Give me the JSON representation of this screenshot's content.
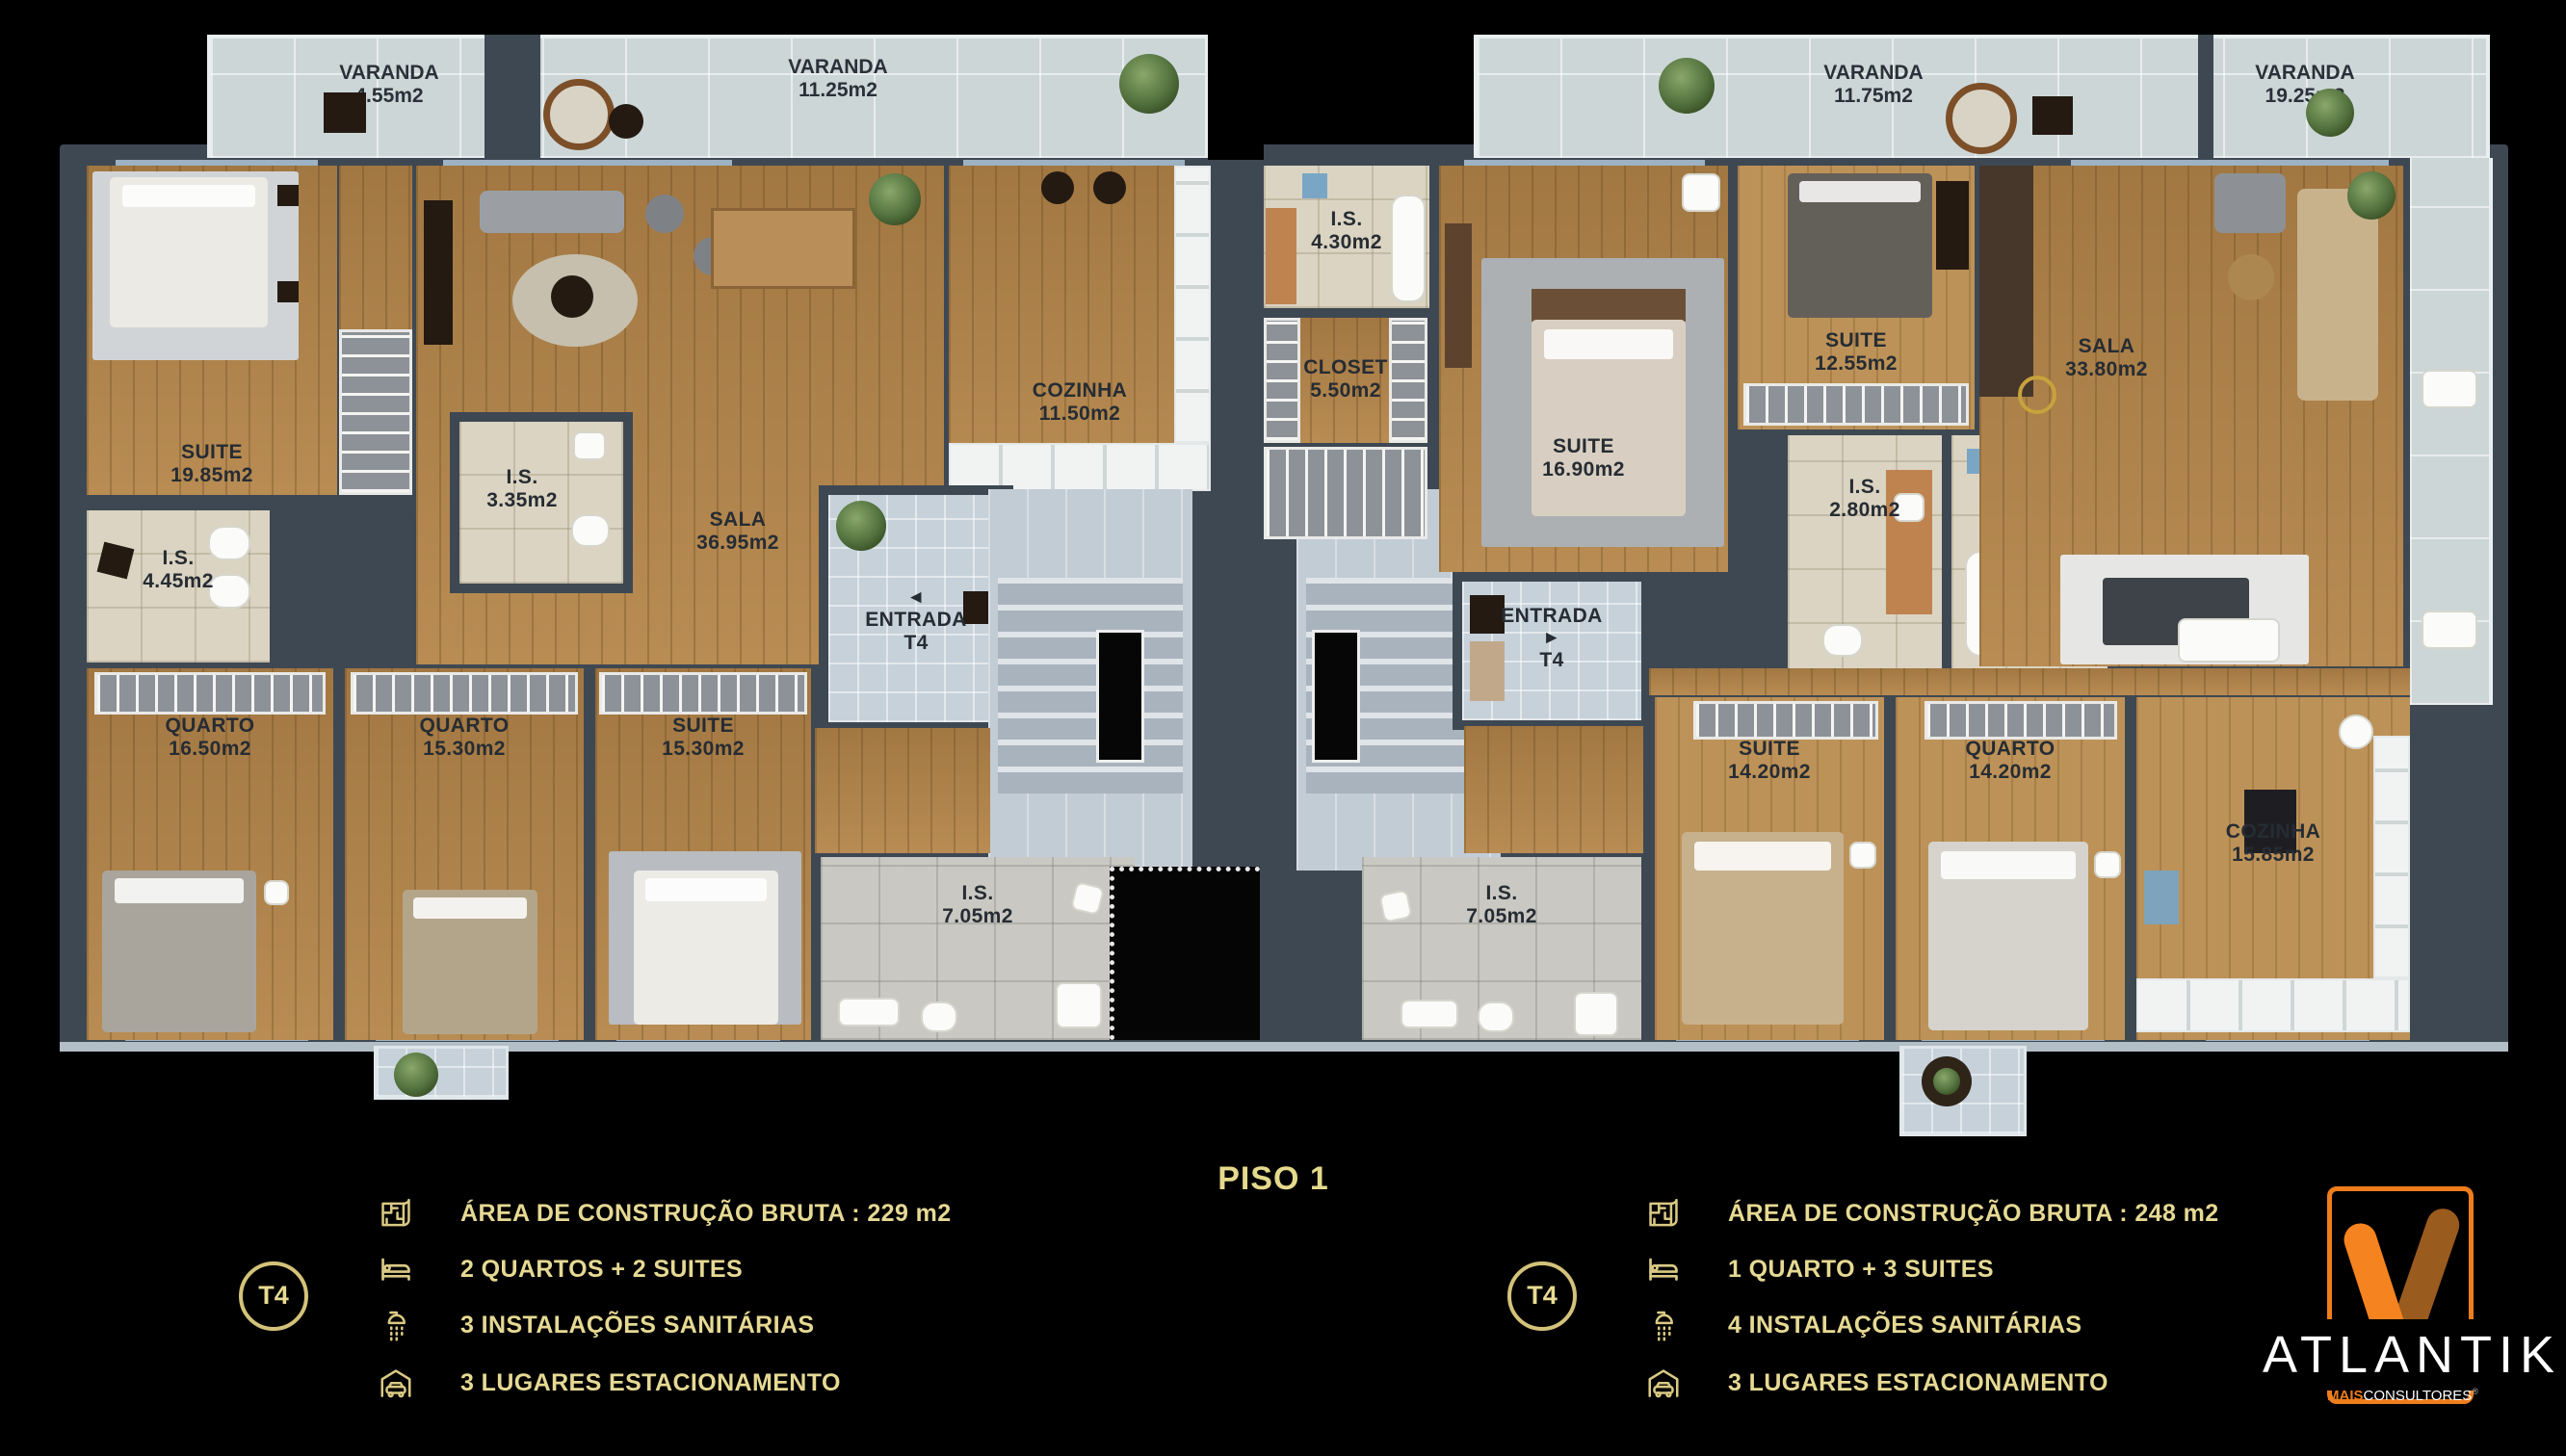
{
  "title": "PISO 1",
  "colors": {
    "accent_gold": "#e5d98c",
    "brand_orange": "#ee7d1c",
    "brand_brown": "#9a5b1e",
    "wall": "#3e4853",
    "wood_floor": "#b0834a"
  },
  "varandas": [
    {
      "name": "VARANDA",
      "area": "4.55m2"
    },
    {
      "name": "VARANDA",
      "area": "11.25m2"
    },
    {
      "name": "VARANDA",
      "area": "11.75m2"
    },
    {
      "name": "VARANDA",
      "area": "19.25m2"
    }
  ],
  "rooms": {
    "l_suite": {
      "name": "SUITE",
      "area": "19.85m2"
    },
    "l_is445": {
      "name": "I.S.",
      "area": "4.45m2"
    },
    "l_is335": {
      "name": "I.S.",
      "area": "3.35m2"
    },
    "l_sala": {
      "name": "SALA",
      "area": "36.95m2"
    },
    "l_cozinha": {
      "name": "COZINHA",
      "area": "11.50m2"
    },
    "l_entrada": {
      "name": "ENTRADA",
      "area": "T4",
      "arrow": "◄"
    },
    "l_quarto1": {
      "name": "QUARTO",
      "area": "16.50m2"
    },
    "l_quarto2": {
      "name": "QUARTO",
      "area": "15.30m2"
    },
    "l_suite2": {
      "name": "SUITE",
      "area": "15.30m2"
    },
    "l_is705": {
      "name": "I.S.",
      "area": "7.05m2"
    },
    "r_is430": {
      "name": "I.S.",
      "area": "4.30m2"
    },
    "r_closet": {
      "name": "CLOSET",
      "area": "5.50m2"
    },
    "r_suite1690": {
      "name": "SUITE",
      "area": "16.90m2"
    },
    "r_suite1255": {
      "name": "SUITE",
      "area": "12.55m2"
    },
    "r_is280": {
      "name": "I.S.",
      "area": "2.80m2"
    },
    "r_is305": {
      "name": "I.S.",
      "area": "3.05m2"
    },
    "r_sala": {
      "name": "SALA",
      "area": "33.80m2"
    },
    "r_entrada": {
      "name": "ENTRADA",
      "area": "T4",
      "arrow": "►"
    },
    "r_suite1420": {
      "name": "SUITE",
      "area": "14.20m2"
    },
    "r_quarto1420": {
      "name": "QUARTO",
      "area": "14.20m2"
    },
    "r_cozinha": {
      "name": "COZINHA",
      "area": "15.85m2"
    },
    "r_is705": {
      "name": "I.S.",
      "area": "7.05m2"
    }
  },
  "legend_left": {
    "badge": "T4",
    "rows": [
      {
        "icon": "floorplan-icon",
        "text": "ÁREA DE CONSTRUÇÃO BRUTA :  229 m2"
      },
      {
        "icon": "bed-icon",
        "text": "2 QUARTOS + 2 SUITES"
      },
      {
        "icon": "shower-icon",
        "text": "3 INSTALAÇÕES SANITÁRIAS"
      },
      {
        "icon": "garage-icon",
        "text": "3 LUGARES ESTACIONAMENTO"
      }
    ]
  },
  "legend_right": {
    "badge": "T4",
    "rows": [
      {
        "icon": "floorplan-icon",
        "text": "ÁREA DE CONSTRUÇÃO BRUTA :  248 m2"
      },
      {
        "icon": "bed-icon",
        "text": "1 QUARTO + 3 SUITES"
      },
      {
        "icon": "shower-icon",
        "text": "4 INSTALAÇÕES SANITÁRIAS"
      },
      {
        "icon": "garage-icon",
        "text": "3 LUGARES ESTACIONAMENTO"
      }
    ]
  },
  "brand": {
    "name": "ATLANTIK",
    "tag_bold": "MAIS",
    "tag_rest": "CONSULTORES",
    "tag_mark": "®"
  }
}
